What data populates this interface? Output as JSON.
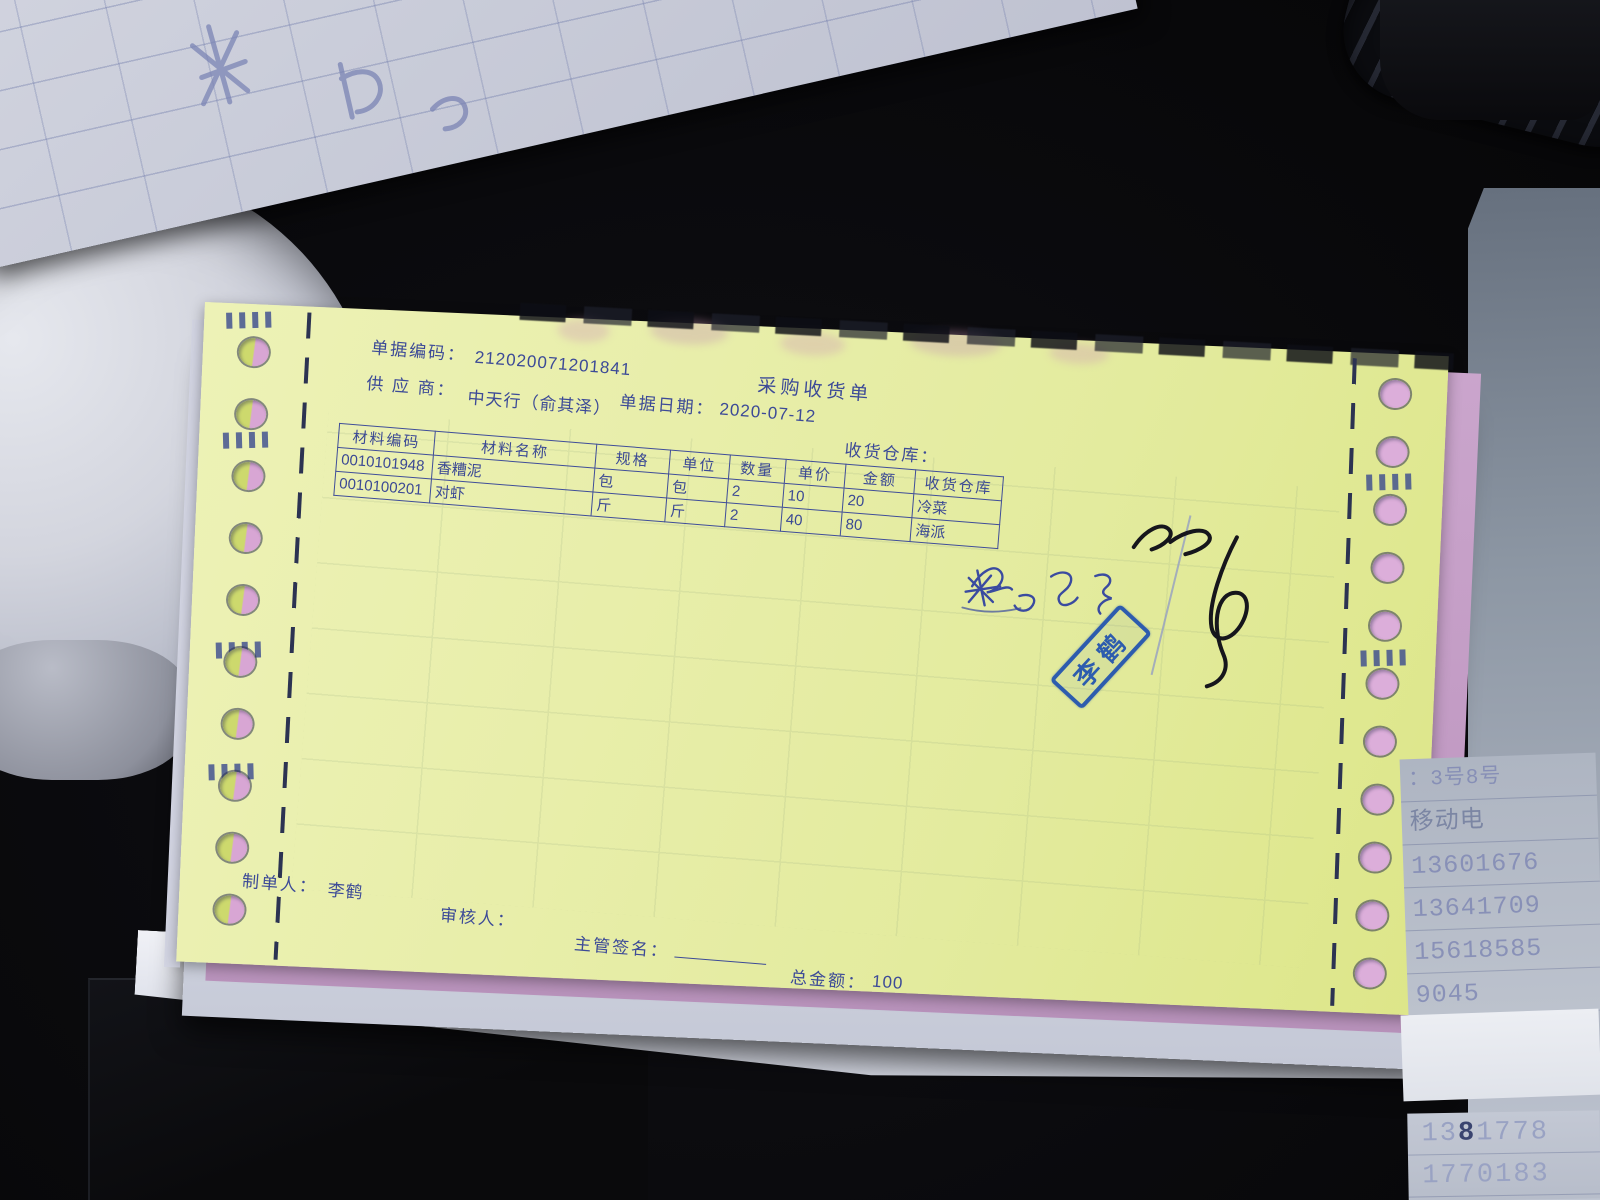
{
  "form": {
    "header": {
      "doc_code_label": "单据编码：",
      "doc_code_value": "212020071201841",
      "title": "采购收货单",
      "date_label": "单据日期：",
      "date_value": "2020-07-12",
      "supplier_label": "供 应 商：",
      "supplier_value": "中天行（俞其泽）",
      "warehouse_label": "收货仓库："
    },
    "table": {
      "headers": [
        "材料编码",
        "材料名称",
        "规格",
        "单位",
        "数量",
        "单价",
        "金额",
        "收货仓库"
      ],
      "rows": [
        [
          "0010101948",
          "香糟泥",
          "包",
          "包",
          "2",
          "10",
          "20",
          "冷菜"
        ],
        [
          "0010100201",
          "对虾",
          "斤",
          "斤",
          "2",
          "40",
          "80",
          "海派"
        ]
      ]
    },
    "footer": {
      "preparer_label": "制单人：",
      "preparer_value": "李鹤",
      "reviewer_label": "审核人：",
      "supervisor_sign_label": "主管签名：",
      "total_label": "总金额：",
      "total_value": "100"
    },
    "stamp": {
      "text": "李鹤"
    }
  },
  "surroundings": {
    "phone_strip": {
      "rows": [
        "：3号8号",
        "移动电",
        "13601676",
        "13641709",
        "15618585",
        "9045"
      ],
      "bottom_rows": [
        {
          "text": "1381778",
          "dark_index": 2
        },
        {
          "text": "1770183",
          "dark_index": -1
        }
      ]
    }
  },
  "colors": {
    "paper_yellow": "#e7eda4",
    "print_blue": "#3c4a97",
    "hole_pink": "#d8a6d4",
    "hole_lime": "#cdd96d",
    "under_pink": "#c29bc4",
    "stamp_blue": "#2d5cae"
  }
}
